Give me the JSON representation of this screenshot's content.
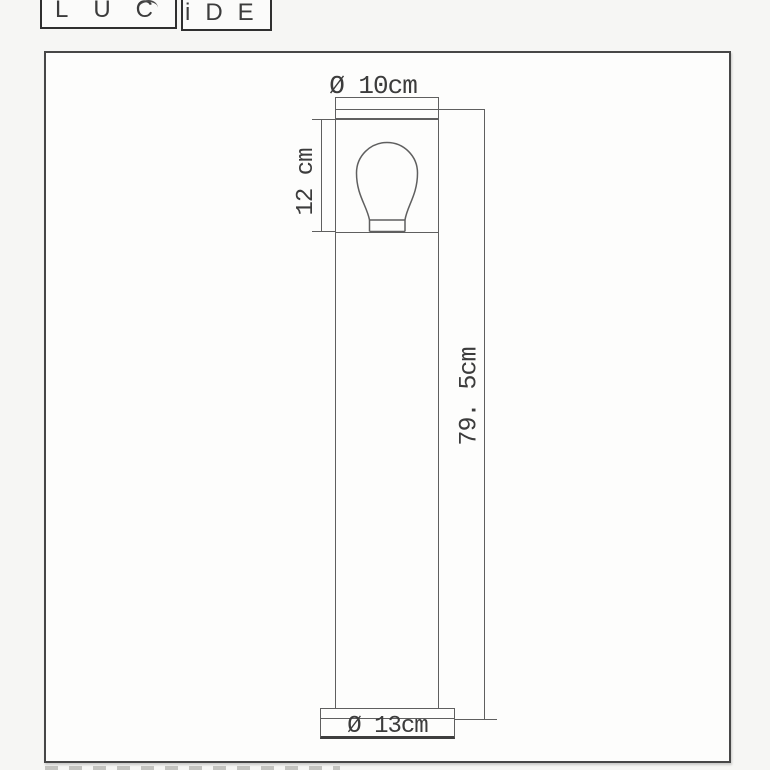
{
  "logo": {
    "left_text": "LUC",
    "right_text": "iDE"
  },
  "drawing": {
    "top_diameter_label": "Ø 10cm",
    "head_height_label": "12 cm",
    "total_height_label": "79. 5cm",
    "base_diameter_label": "Ø 13cm",
    "line_color": "#5f5f5f",
    "text_color": "#3c3c3c",
    "frame_border_color": "#474747"
  }
}
